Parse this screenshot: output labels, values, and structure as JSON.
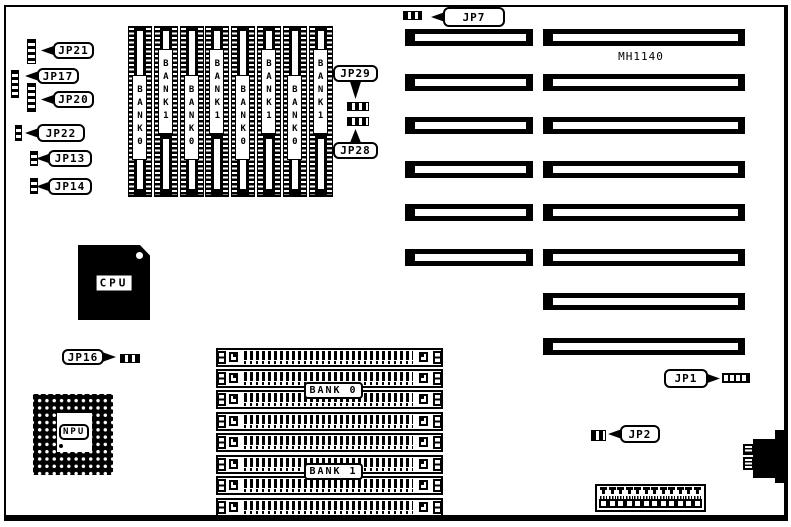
{
  "board": {
    "model_label": "MH1140"
  },
  "processors": {
    "cpu_label": "CPU",
    "npu_label": "NPU"
  },
  "jumper_callouts": {
    "jp21": "JP21",
    "jp17": "JP17",
    "jp20": "JP20",
    "jp22": "JP22",
    "jp13": "JP13",
    "jp14": "JP14",
    "jp7": "JP7",
    "jp29": "JP29",
    "jp28": "JP28",
    "jp16": "JP16",
    "jp1": "JP1",
    "jp2": "JP2"
  },
  "dram_chips": {
    "count": 8,
    "bank_labels": [
      "BANK0",
      "BANK1",
      "BANK0",
      "BANK1",
      "BANK0",
      "BANK1",
      "BANK0",
      "BANK1"
    ]
  },
  "simm_sockets": {
    "rows": 8,
    "bank0_label": "BANK 0",
    "bank1_label": "BANK 1"
  },
  "expansion_slots": {
    "left_column_count": 6,
    "right_column_count": 8
  },
  "power_connector": {
    "pin_count": 12
  }
}
